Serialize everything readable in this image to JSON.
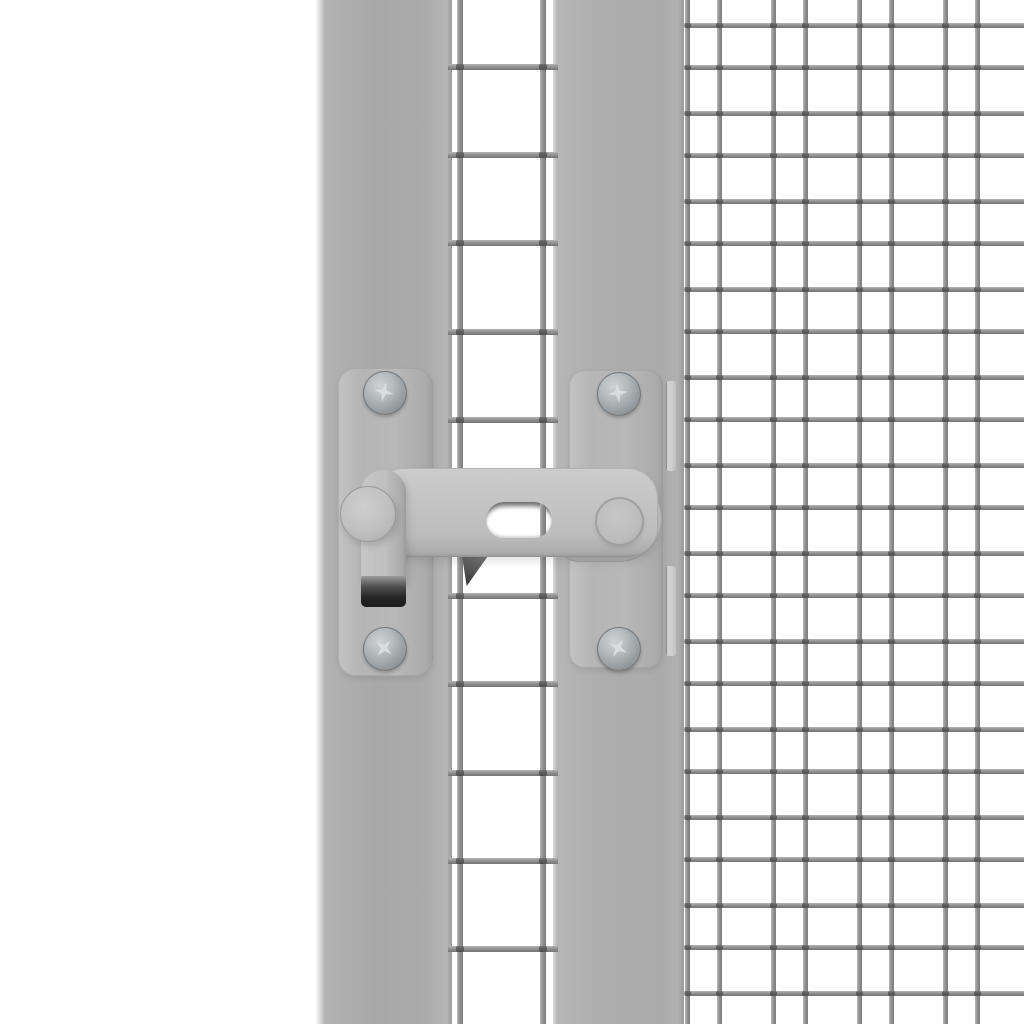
{
  "scene": {
    "description": "Close-up product photo of a grey metal gate latch mounted between a gate frame bar and a galvanised wire mesh panel on a white background",
    "background_color": "#ffffff"
  },
  "palette": {
    "background": "#ffffff",
    "frame_bar_grey": "#ababab",
    "mount_plate_grey": "#b7b7b7",
    "latch_arm_grey": "#c3c3c3",
    "wire_grey": "#909090",
    "wire_joint_dark": "#2a2a2a",
    "hook_tip_dark": "#262626",
    "screw_metal_light": "#ced2d4",
    "screw_metal_dark": "#7a7f82"
  },
  "frame": {
    "left_bar": {
      "x": 316,
      "width": 136
    },
    "right_bar": {
      "x": 553,
      "width": 131
    },
    "clip_slots_y": [
      381,
      566
    ]
  },
  "mesh": {
    "strip": {
      "vertical_x": [
        457,
        540
      ],
      "horizontal_y": [
        64,
        152,
        240,
        329,
        417,
        505,
        593,
        681,
        770,
        858,
        946
      ],
      "h_span": [
        448,
        558
      ],
      "wire_px": 6
    },
    "panel": {
      "vertical_x": [
        685,
        717,
        771,
        803,
        857,
        889,
        943,
        975
      ],
      "horizontal_y": [
        23,
        65,
        111,
        153,
        199,
        241,
        287,
        329,
        375,
        417,
        463,
        505,
        551,
        593,
        639,
        681,
        727,
        769,
        815,
        857,
        903,
        945,
        991
      ],
      "h_span": [
        686,
        1024
      ],
      "wire_px": 5
    }
  },
  "latch": {
    "parts": [
      "left mount plate",
      "right mount plate",
      "pivot bolt",
      "swing latch arm with adjustment slot",
      "guide pin",
      "catch bracket",
      "drop handle strap with dark folded tip"
    ],
    "screw_count": 4,
    "screw_type": "phillips pan-head"
  }
}
